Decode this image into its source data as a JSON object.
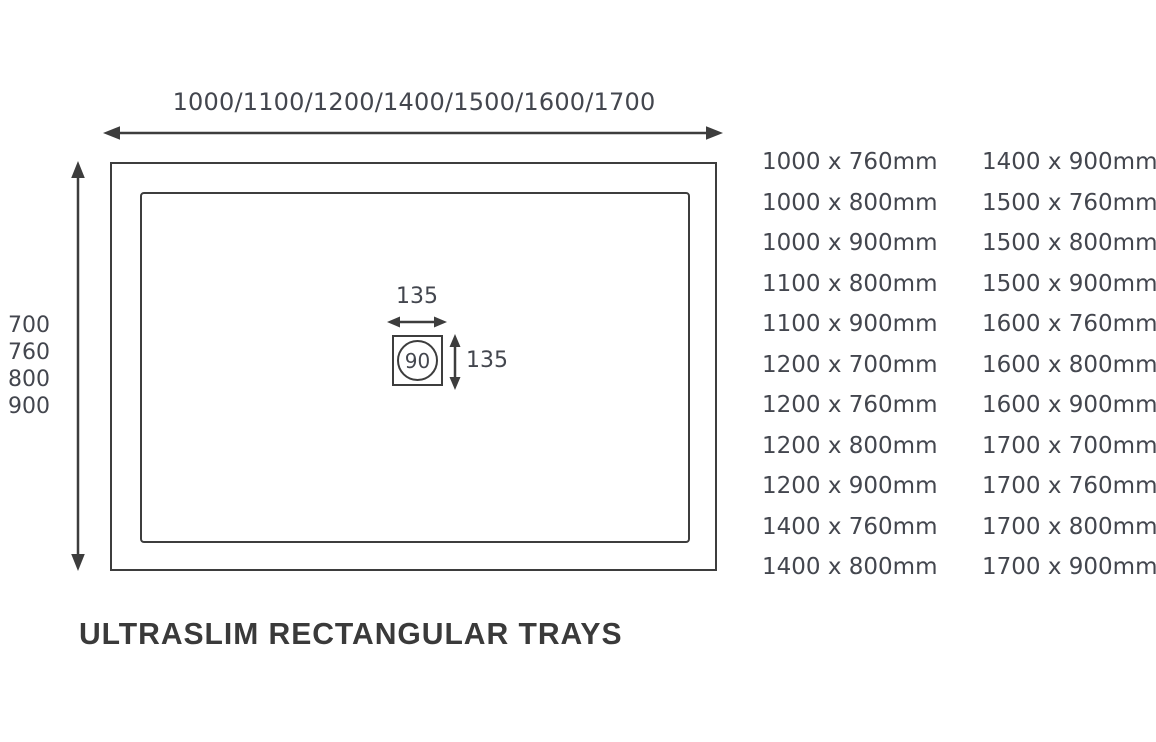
{
  "title": {
    "text": "ULTRASLIM RECTANGULAR TRAYS"
  },
  "diagram": {
    "width_options": "1000/1100/1200/1400/1500/1600/1700",
    "depth_options": [
      "700",
      "760",
      "800",
      "900"
    ],
    "waste": {
      "width_label": "135",
      "height_label": "135",
      "outlet_label": "90"
    }
  },
  "sizes": {
    "col1": [
      "1000 x 760mm",
      "1000 x 800mm",
      "1000 x 900mm",
      "1100 x 800mm",
      "1100 x 900mm",
      "1200 x 700mm",
      "1200 x 760mm",
      "1200 x 800mm",
      "1200 x 900mm",
      "1400 x 760mm",
      "1400 x 800mm"
    ],
    "col2": [
      "1400 x 900mm",
      "1500 x 760mm",
      "1500 x 800mm",
      "1500 x 900mm",
      "1600 x 760mm",
      "1600 x 800mm",
      "1600 x 900mm",
      "1700 x 700mm",
      "1700 x 760mm",
      "1700 x 800mm",
      "1700 x 900mm"
    ]
  },
  "colors": {
    "line": "#3d3d3d",
    "text": "#43464e",
    "title": "#3a3a3a",
    "background": "#ffffff"
  }
}
